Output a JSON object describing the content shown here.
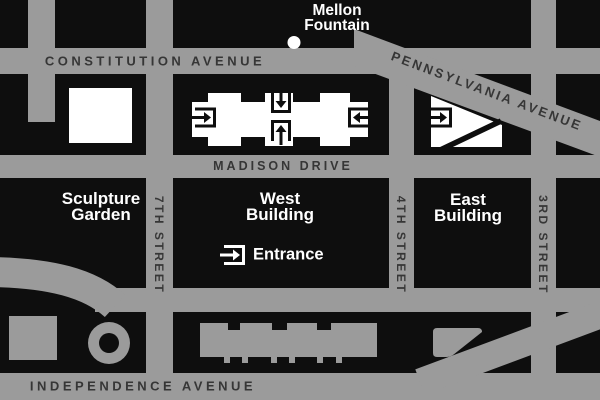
{
  "colors": {
    "background": "#0e0e0e",
    "road": "#9b9b9b",
    "road_label": "#363636",
    "place_label": "#ffffff",
    "footprint_white": "#ffffff"
  },
  "roads": {
    "constitution": "CONSTITUTION AVENUE",
    "pennsylvania": "PENNSYLVANIA AVENUE",
    "madison": "MADISON DRIVE",
    "independence": "INDEPENDENCE AVENUE",
    "seventh": "7TH STREET",
    "fourth": "4TH STREET",
    "third": "3RD STREET"
  },
  "places": {
    "mellon_fountain": {
      "line1": "Mellon",
      "line2": "Fountain"
    },
    "sculpture_garden": {
      "line1": "Sculpture",
      "line2": "Garden"
    },
    "west_building": {
      "line1": "West",
      "line2": "Building"
    },
    "east_building": {
      "line1": "East",
      "line2": "Building"
    }
  },
  "legend": {
    "entrance_label": "Entrance"
  },
  "icons": {
    "entrance": "entrance-arrow-icon",
    "fountain": "fountain-dot"
  }
}
